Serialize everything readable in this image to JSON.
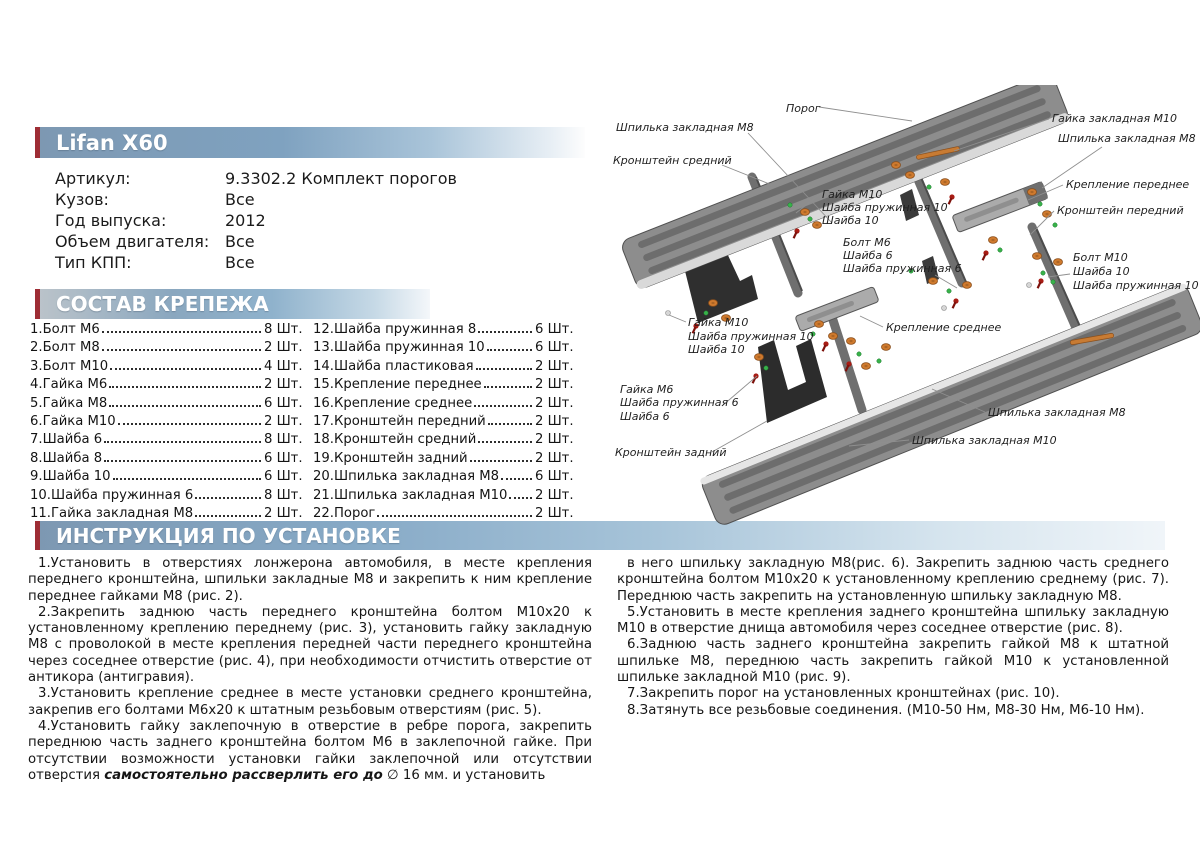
{
  "product": {
    "title": "Lifan X60",
    "specs": [
      {
        "label": "Артикул:",
        "value": "9.3302.2 Комплект порогов"
      },
      {
        "label": "Кузов:",
        "value": "Все"
      },
      {
        "label": "Год выпуска:",
        "value": "2012"
      },
      {
        "label": "Объем двигателя:",
        "value": "Все"
      },
      {
        "label": "Тип КПП:",
        "value": "Все"
      }
    ]
  },
  "sections": {
    "parts_title": "СОСТАВ КРЕПЕЖА",
    "install_title": "ИНСТРУКЦИЯ ПО УСТАНОВКЕ"
  },
  "parts": {
    "col1": [
      {
        "name": "1.Болт М6",
        "qty": "8 Шт."
      },
      {
        "name": "2.Болт М8",
        "qty": "2 Шт."
      },
      {
        "name": "3.Болт М10",
        "qty": "4 Шт."
      },
      {
        "name": "4.Гайка М6",
        "qty": "2 Шт."
      },
      {
        "name": "5.Гайка М8",
        "qty": "6 Шт."
      },
      {
        "name": "6.Гайка М10",
        "qty": "2 Шт."
      },
      {
        "name": "7.Шайба 6",
        "qty": "8 Шт."
      },
      {
        "name": "8.Шайба 8",
        "qty": "6 Шт."
      },
      {
        "name": "9.Шайба 10",
        "qty": "6 Шт."
      },
      {
        "name": "10.Шайба пружинная 6",
        "qty": "8 Шт."
      },
      {
        "name": "11.Гайка закладная М8",
        "qty": "2 Шт."
      }
    ],
    "col2": [
      {
        "name": "12.Шайба пружинная 8",
        "qty": "6 Шт."
      },
      {
        "name": "13.Шайба пружинная 10",
        "qty": "6 Шт."
      },
      {
        "name": "14.Шайба пластиковая",
        "qty": "2 Шт."
      },
      {
        "name": "15.Крепление переднее",
        "qty": "2 Шт."
      },
      {
        "name": "16.Крепление среднее",
        "qty": "2 Шт."
      },
      {
        "name": "17.Кронштейн передний",
        "qty": "2 Шт."
      },
      {
        "name": "18.Кронштейн средний",
        "qty": "2 Шт."
      },
      {
        "name": "19.Кронштейн задний",
        "qty": "2 Шт."
      },
      {
        "name": "20.Шпилька закладная М8",
        "qty": "6 Шт."
      },
      {
        "name": "21.Шпилька закладная М10",
        "qty": "2 Шт."
      },
      {
        "name": "22.Порог",
        "qty": "2 Шт."
      }
    ]
  },
  "instructions": {
    "left": [
      [
        {
          "t": "1.Установить в отверстиях лонжерона автомобиля, в месте крепления переднего кронштейна, шпильки закладные М8 и закрепить к ним крепление переднее гайками М8 (рис. 2)."
        }
      ],
      [
        {
          "t": "2.Закрепить заднюю часть переднего кронштейна болтом М10х20 к установленному креплению переднему (рис. 3), установить гайку закладную М8 с проволокой в месте крепления передней части переднего кронштейна через соседнее отверстие (рис. 4), при необходимости отчистить отверстие от антикора (антигравия)."
        }
      ],
      [
        {
          "t": "3.Установить крепление среднее в месте установки среднего кронштейна, закрепив его болтами М6х20 к штатным резьбовым отверстиям (рис. 5)."
        }
      ],
      [
        {
          "t": "4.Установить гайку заклепочную в отверстие в ребре порога, закрепить переднюю часть заднего кронштейна болтом М6 в заклепочной гайке. При отсутствии возможности установки гайки заклепочной или отсутствии отверстия "
        },
        {
          "t": "самостоятельно рассверлить его до",
          "b": true
        },
        {
          "t": " ∅ 16 мм. и установить"
        }
      ]
    ],
    "right": [
      [
        {
          "t": "в него шпильку закладную М8(рис. 6).  Закрепить заднюю часть среднего кронштейна болтом М10х20 к установленному креплению среднему (рис. 7).  Переднюю часть закрепить на установленную шпильку закладную М8."
        }
      ],
      [
        {
          "t": "5.Установить в месте крепления заднего кронштейна шпильку закладную М10 в отверстие днища автомобиля через соседнее отверстие (рис. 8)."
        }
      ],
      [
        {
          "t": "6.Заднюю часть заднего кронштейна закрепить гайкой М8 к штатной шпильке М8, переднюю часть закрепить гайкой М10 к установленной шпильке закладной М10 (рис. 9)."
        }
      ],
      [
        {
          "t": "7.Закрепить порог на установленных кронштейнах (рис. 10)."
        }
      ],
      [
        {
          "t": "8.Затянуть все резьбовые соединения.  (М10-50 Нм, М8-30 Нм, М6-10 Нм)."
        }
      ]
    ]
  },
  "diagram": {
    "labels": [
      {
        "t": "Порог",
        "x": 186,
        "y": 27
      },
      {
        "t": "Шпилька закладная М8",
        "x": 16,
        "y": 46
      },
      {
        "t": "Кронштейн средний",
        "x": 13,
        "y": 79
      },
      {
        "t": "Гайка закладная М10",
        "x": 452,
        "y": 37
      },
      {
        "t": "Шпилька закладная М8",
        "x": 458,
        "y": 57
      },
      {
        "t": "Крепление переднее",
        "x": 466,
        "y": 103
      },
      {
        "t": "Кронштейн передний",
        "x": 457,
        "y": 129
      },
      {
        "t": "Гайка М10",
        "x": 222,
        "y": 113
      },
      {
        "t": "Шайба пружинная 10",
        "x": 222,
        "y": 126
      },
      {
        "t": "Шайба 10",
        "x": 222,
        "y": 139
      },
      {
        "t": "Болт М6",
        "x": 243,
        "y": 161
      },
      {
        "t": "Шайба 6",
        "x": 243,
        "y": 174
      },
      {
        "t": "Шайба пружинная 6",
        "x": 243,
        "y": 187
      },
      {
        "t": "Болт М10",
        "x": 473,
        "y": 176
      },
      {
        "t": "Шайба 10",
        "x": 473,
        "y": 190
      },
      {
        "t": "Шайба пружинная 10",
        "x": 473,
        "y": 204
      },
      {
        "t": "Гайка М10",
        "x": 88,
        "y": 241
      },
      {
        "t": "Шайба пружинная 10",
        "x": 88,
        "y": 255
      },
      {
        "t": "Шайба 10",
        "x": 88,
        "y": 268
      },
      {
        "t": "Крепление среднее",
        "x": 286,
        "y": 246
      },
      {
        "t": "Гайка М6",
        "x": 20,
        "y": 308
      },
      {
        "t": "Шайба пружинная 6",
        "x": 20,
        "y": 321
      },
      {
        "t": "Шайба 6",
        "x": 20,
        "y": 335
      },
      {
        "t": "Кронштейн задний",
        "x": 15,
        "y": 371
      },
      {
        "t": "Шпилька закладная М8",
        "x": 388,
        "y": 331
      },
      {
        "t": "Шпилька закладная М10",
        "x": 312,
        "y": 359
      }
    ],
    "leaders": [
      [
        219,
        22,
        312,
        36
      ],
      [
        148,
        48,
        232,
        138
      ],
      [
        122,
        80,
        172,
        100
      ],
      [
        449,
        34,
        354,
        66
      ],
      [
        502,
        62,
        442,
        103
      ],
      [
        463,
        100,
        428,
        115
      ],
      [
        454,
        126,
        430,
        150
      ],
      [
        220,
        109,
        196,
        128
      ],
      [
        335,
        190,
        357,
        203
      ],
      [
        470,
        189,
        448,
        192
      ],
      [
        86,
        237,
        69,
        230
      ],
      [
        283,
        242,
        260,
        231
      ],
      [
        122,
        321,
        157,
        291
      ],
      [
        112,
        367,
        167,
        336
      ],
      [
        385,
        327,
        332,
        304
      ],
      [
        309,
        355,
        249,
        361
      ]
    ]
  },
  "colors": {
    "accent_red": "#9e2d35",
    "bar_blue": "#7fa2c0",
    "fastener_orange": "#cf7a2e",
    "fastener_green": "#38b24a",
    "fastener_red": "#a81c14"
  }
}
